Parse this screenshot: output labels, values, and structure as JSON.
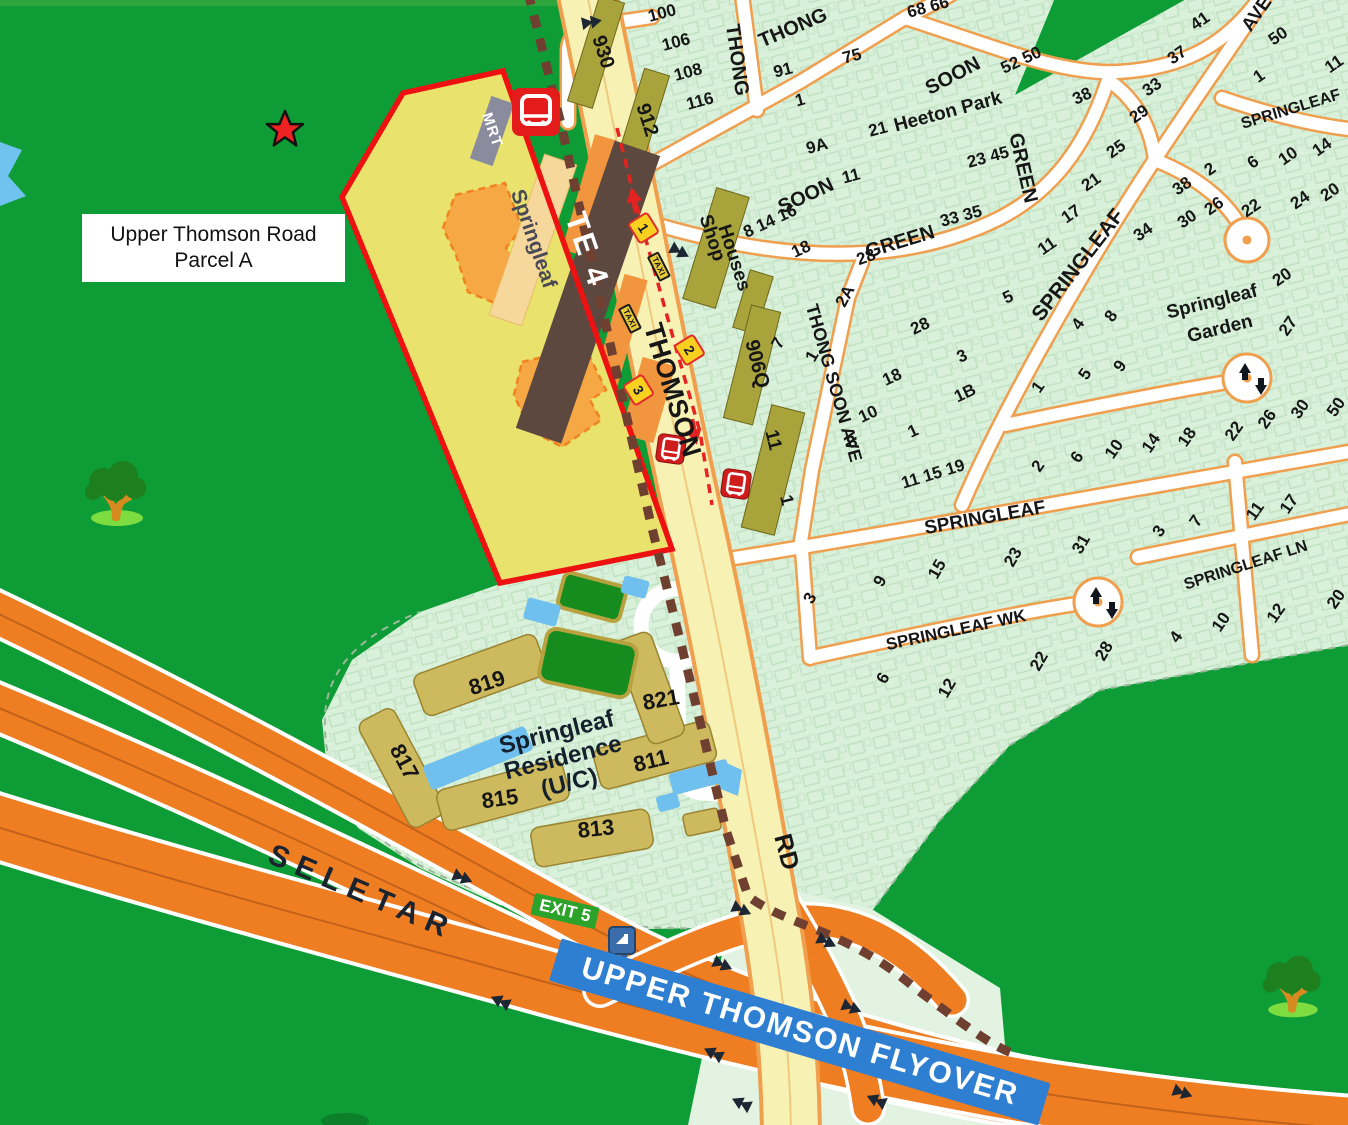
{
  "parcel_label": {
    "line1": "Upper Thomson Road",
    "line2": "Parcel A"
  },
  "station": {
    "mrt_tag": "MRT",
    "name": "Springleaf",
    "code": "TE 4"
  },
  "expressway": {
    "name": "SELETAR",
    "exit": "EXIT 5"
  },
  "flyover": {
    "label": "UPPER THOMSON FLYOVER"
  },
  "residence": {
    "line1": "Springleaf",
    "line2": "Residence",
    "line3": "(U/C)"
  },
  "badges": {
    "bus_stops": [
      "1",
      "2",
      "3"
    ],
    "taxi": "TAXI"
  },
  "icons": [
    "star-icon",
    "mrt-train-icon",
    "bus-stop-icon",
    "bus-stop-icon",
    "road-sign-icon",
    "tree-icon",
    "tree-icon"
  ],
  "colors": {
    "forest_green": "#0d9c35",
    "estate_green": "#d9f0da",
    "parcel_yellow": "#e9e36e",
    "parcel_red": "#ee1111",
    "road_yellow": "#f8f1b4",
    "road_casing": "#ef9f4e",
    "expressway_orange": "#ef7e22",
    "shophouse_olive": "#a9a33c",
    "residence_olive": "#cdb95e",
    "water_blue": "#6fc3ef",
    "flyover_blue": "#2e7fd2",
    "exit_green": "#2ba32b",
    "station_brown": "#5d483f",
    "mrt_red": "#e31b1b"
  },
  "map_labels": [
    {
      "t": "THOMSON",
      "x": 672,
      "y": 390,
      "r": 73,
      "s": 27
    },
    {
      "t": "RD",
      "x": 786,
      "y": 852,
      "r": 75,
      "s": 25
    },
    {
      "t": "THONG",
      "x": 737,
      "y": 60,
      "r": 82,
      "s": 20
    },
    {
      "t": "THONG",
      "x": 793,
      "y": 28,
      "r": -23,
      "s": 20
    },
    {
      "t": "SOON",
      "x": 953,
      "y": 76,
      "r": -28,
      "s": 20
    },
    {
      "t": "Heeton Park",
      "x": 948,
      "y": 112,
      "r": -15,
      "s": 19
    },
    {
      "t": "SOON",
      "x": 806,
      "y": 196,
      "r": -25,
      "s": 20
    },
    {
      "t": "GREEN",
      "x": 900,
      "y": 242,
      "r": -17,
      "s": 20
    },
    {
      "t": "GREEN",
      "x": 1023,
      "y": 168,
      "r": 77,
      "s": 20
    },
    {
      "t": "SPRINGLEAF",
      "x": 1078,
      "y": 265,
      "r": -52,
      "s": 21
    },
    {
      "t": "AVE",
      "x": 1257,
      "y": 14,
      "r": -55,
      "s": 19
    },
    {
      "t": "SPRINGLEAF",
      "x": 1291,
      "y": 110,
      "r": -17,
      "s": 16
    },
    {
      "t": "THONG SOON AVE",
      "x": 834,
      "y": 383,
      "r": 74,
      "s": 18
    },
    {
      "t": "SPRINGLEAF",
      "x": 985,
      "y": 518,
      "r": -10,
      "s": 19
    },
    {
      "t": "SPRINGLEAF WK",
      "x": 956,
      "y": 630,
      "r": -12,
      "s": 17
    },
    {
      "t": "SPRINGLEAF LN",
      "x": 1246,
      "y": 566,
      "r": -18,
      "s": 16
    },
    {
      "t": "Springleaf",
      "x": 1212,
      "y": 302,
      "r": -14,
      "s": 19
    },
    {
      "t": "Garden",
      "x": 1220,
      "y": 329,
      "r": -14,
      "s": 19
    },
    {
      "t": "Shop",
      "x": 712,
      "y": 238,
      "r": 72,
      "s": 19
    },
    {
      "t": "Houses",
      "x": 734,
      "y": 258,
      "r": 72,
      "s": 19
    },
    {
      "t": "930",
      "x": 603,
      "y": 52,
      "r": 72,
      "s": 20
    },
    {
      "t": "912",
      "x": 647,
      "y": 120,
      "r": 72,
      "s": 20
    },
    {
      "t": "906Q",
      "x": 757,
      "y": 364,
      "r": 76,
      "s": 20
    },
    {
      "t": "11",
      "x": 773,
      "y": 440,
      "r": 76,
      "s": 19
    },
    {
      "t": "1",
      "x": 787,
      "y": 500,
      "r": 76,
      "s": 18
    },
    {
      "t": "100",
      "x": 662,
      "y": 13,
      "r": -15,
      "s": 17
    },
    {
      "t": "106",
      "x": 676,
      "y": 42,
      "r": -15,
      "s": 17
    },
    {
      "t": "108",
      "x": 688,
      "y": 72,
      "r": -15,
      "s": 17
    },
    {
      "t": "116",
      "x": 700,
      "y": 101,
      "r": -15,
      "s": 17
    },
    {
      "t": "91",
      "x": 783,
      "y": 70,
      "r": -15,
      "s": 17
    },
    {
      "t": "75",
      "x": 852,
      "y": 56,
      "r": -15,
      "s": 17
    },
    {
      "t": "1",
      "x": 800,
      "y": 100,
      "r": -15,
      "s": 17
    },
    {
      "t": "9A",
      "x": 817,
      "y": 146,
      "r": -15,
      "s": 17
    },
    {
      "t": "21",
      "x": 878,
      "y": 129,
      "r": -15,
      "s": 17
    },
    {
      "t": "23 45",
      "x": 988,
      "y": 157,
      "r": -15,
      "s": 17
    },
    {
      "t": "11",
      "x": 851,
      "y": 176,
      "r": -15,
      "s": 17
    },
    {
      "t": "33 35",
      "x": 961,
      "y": 216,
      "r": -15,
      "s": 17
    },
    {
      "t": "68 66",
      "x": 928,
      "y": 7,
      "r": -15,
      "s": 17
    },
    {
      "t": "52 50",
      "x": 1021,
      "y": 60,
      "r": -25,
      "s": 17
    },
    {
      "t": "38",
      "x": 1082,
      "y": 96,
      "r": -25,
      "s": 17
    },
    {
      "t": "8 14 16",
      "x": 770,
      "y": 221,
      "r": -25,
      "s": 17
    },
    {
      "t": "18",
      "x": 801,
      "y": 249,
      "r": -25,
      "s": 17
    },
    {
      "t": "28",
      "x": 866,
      "y": 257,
      "r": -20,
      "s": 17
    },
    {
      "t": "41",
      "x": 1200,
      "y": 21,
      "r": -35,
      "s": 17
    },
    {
      "t": "37",
      "x": 1177,
      "y": 55,
      "r": -35,
      "s": 17
    },
    {
      "t": "33",
      "x": 1152,
      "y": 87,
      "r": -35,
      "s": 17
    },
    {
      "t": "29",
      "x": 1139,
      "y": 114,
      "r": -35,
      "s": 17
    },
    {
      "t": "25",
      "x": 1116,
      "y": 149,
      "r": -35,
      "s": 17
    },
    {
      "t": "21",
      "x": 1091,
      "y": 182,
      "r": -35,
      "s": 17
    },
    {
      "t": "17",
      "x": 1071,
      "y": 214,
      "r": -35,
      "s": 17
    },
    {
      "t": "11",
      "x": 1047,
      "y": 246,
      "r": -35,
      "s": 17
    },
    {
      "t": "50",
      "x": 1278,
      "y": 36,
      "r": -35,
      "s": 17
    },
    {
      "t": "1",
      "x": 1259,
      "y": 76,
      "r": -35,
      "s": 17
    },
    {
      "t": "11",
      "x": 1334,
      "y": 64,
      "r": -35,
      "s": 17
    },
    {
      "t": "14",
      "x": 1322,
      "y": 147,
      "r": -35,
      "s": 17
    },
    {
      "t": "10",
      "x": 1288,
      "y": 156,
      "r": -35,
      "s": 17
    },
    {
      "t": "6",
      "x": 1253,
      "y": 162,
      "r": -35,
      "s": 17
    },
    {
      "t": "2",
      "x": 1210,
      "y": 169,
      "r": -35,
      "s": 17
    },
    {
      "t": "20",
      "x": 1330,
      "y": 192,
      "r": -35,
      "s": 17
    },
    {
      "t": "24",
      "x": 1300,
      "y": 200,
      "r": -35,
      "s": 17
    },
    {
      "t": "22",
      "x": 1251,
      "y": 208,
      "r": -35,
      "s": 17
    },
    {
      "t": "26",
      "x": 1214,
      "y": 206,
      "r": -35,
      "s": 17
    },
    {
      "t": "30",
      "x": 1187,
      "y": 219,
      "r": -35,
      "s": 17
    },
    {
      "t": "38",
      "x": 1182,
      "y": 186,
      "r": -35,
      "s": 17
    },
    {
      "t": "34",
      "x": 1143,
      "y": 232,
      "r": -35,
      "s": 17
    },
    {
      "t": "20",
      "x": 1282,
      "y": 277,
      "r": -35,
      "s": 17
    },
    {
      "t": "8",
      "x": 1111,
      "y": 316,
      "r": -55,
      "s": 17
    },
    {
      "t": "4",
      "x": 1078,
      "y": 324,
      "r": -55,
      "s": 17
    },
    {
      "t": "9",
      "x": 1120,
      "y": 366,
      "r": -55,
      "s": 17
    },
    {
      "t": "5",
      "x": 1085,
      "y": 374,
      "r": -55,
      "s": 17
    },
    {
      "t": "1",
      "x": 1038,
      "y": 387,
      "r": -55,
      "s": 17
    },
    {
      "t": "27",
      "x": 1288,
      "y": 326,
      "r": -55,
      "s": 17
    },
    {
      "t": "30",
      "x": 1300,
      "y": 409,
      "r": -55,
      "s": 17
    },
    {
      "t": "50",
      "x": 1336,
      "y": 407,
      "r": -55,
      "s": 17
    },
    {
      "t": "26",
      "x": 1267,
      "y": 419,
      "r": -55,
      "s": 17
    },
    {
      "t": "22",
      "x": 1234,
      "y": 431,
      "r": -55,
      "s": 17
    },
    {
      "t": "18",
      "x": 1187,
      "y": 437,
      "r": -55,
      "s": 17
    },
    {
      "t": "14",
      "x": 1151,
      "y": 443,
      "r": -55,
      "s": 17
    },
    {
      "t": "10",
      "x": 1114,
      "y": 449,
      "r": -55,
      "s": 17
    },
    {
      "t": "6",
      "x": 1077,
      "y": 457,
      "r": -55,
      "s": 17
    },
    {
      "t": "2",
      "x": 1038,
      "y": 466,
      "r": -55,
      "s": 17
    },
    {
      "t": "2A",
      "x": 845,
      "y": 296,
      "r": -62,
      "s": 17
    },
    {
      "t": "5",
      "x": 1008,
      "y": 297,
      "r": -25,
      "s": 17
    },
    {
      "t": "28",
      "x": 920,
      "y": 326,
      "r": -25,
      "s": 17
    },
    {
      "t": "3",
      "x": 962,
      "y": 356,
      "r": -25,
      "s": 17
    },
    {
      "t": "18",
      "x": 892,
      "y": 377,
      "r": -25,
      "s": 17
    },
    {
      "t": "1B",
      "x": 965,
      "y": 393,
      "r": -25,
      "s": 17
    },
    {
      "t": "10",
      "x": 868,
      "y": 414,
      "r": -25,
      "s": 17
    },
    {
      "t": "1",
      "x": 913,
      "y": 431,
      "r": -25,
      "s": 17
    },
    {
      "t": "8",
      "x": 852,
      "y": 442,
      "r": -25,
      "s": 17
    },
    {
      "t": "7",
      "x": 778,
      "y": 343,
      "r": -60,
      "s": 17
    },
    {
      "t": "1",
      "x": 812,
      "y": 356,
      "r": -60,
      "s": 17
    },
    {
      "t": "11 15 19",
      "x": 933,
      "y": 474,
      "r": -17,
      "s": 17
    },
    {
      "t": "7",
      "x": 1196,
      "y": 521,
      "r": -55,
      "s": 17
    },
    {
      "t": "3",
      "x": 1159,
      "y": 531,
      "r": -55,
      "s": 17
    },
    {
      "t": "17",
      "x": 1289,
      "y": 504,
      "r": -55,
      "s": 17
    },
    {
      "t": "11",
      "x": 1255,
      "y": 511,
      "r": -55,
      "s": 17
    },
    {
      "t": "31",
      "x": 1081,
      "y": 544,
      "r": -60,
      "s": 17
    },
    {
      "t": "23",
      "x": 1013,
      "y": 557,
      "r": -60,
      "s": 17
    },
    {
      "t": "15",
      "x": 937,
      "y": 569,
      "r": -60,
      "s": 17
    },
    {
      "t": "9",
      "x": 880,
      "y": 581,
      "r": -60,
      "s": 17
    },
    {
      "t": "3",
      "x": 810,
      "y": 598,
      "r": -60,
      "s": 17
    },
    {
      "t": "6",
      "x": 883,
      "y": 678,
      "r": -60,
      "s": 17
    },
    {
      "t": "12",
      "x": 947,
      "y": 688,
      "r": -60,
      "s": 17
    },
    {
      "t": "22",
      "x": 1039,
      "y": 661,
      "r": -60,
      "s": 17
    },
    {
      "t": "28",
      "x": 1104,
      "y": 651,
      "r": -60,
      "s": 17
    },
    {
      "t": "4",
      "x": 1176,
      "y": 637,
      "r": -55,
      "s": 17
    },
    {
      "t": "10",
      "x": 1221,
      "y": 622,
      "r": -55,
      "s": 17
    },
    {
      "t": "12",
      "x": 1276,
      "y": 613,
      "r": -55,
      "s": 17
    },
    {
      "t": "20",
      "x": 1336,
      "y": 599,
      "r": -55,
      "s": 17
    },
    {
      "t": "819",
      "x": 487,
      "y": 683,
      "r": -18,
      "s": 22
    },
    {
      "t": "821",
      "x": 661,
      "y": 700,
      "r": -10,
      "s": 22
    },
    {
      "t": "817",
      "x": 404,
      "y": 762,
      "r": 62,
      "s": 22
    },
    {
      "t": "811",
      "x": 651,
      "y": 761,
      "r": -14,
      "s": 22
    },
    {
      "t": "815",
      "x": 500,
      "y": 799,
      "r": -8,
      "s": 22
    },
    {
      "t": "813",
      "x": 596,
      "y": 829,
      "r": -6,
      "s": 22
    }
  ]
}
